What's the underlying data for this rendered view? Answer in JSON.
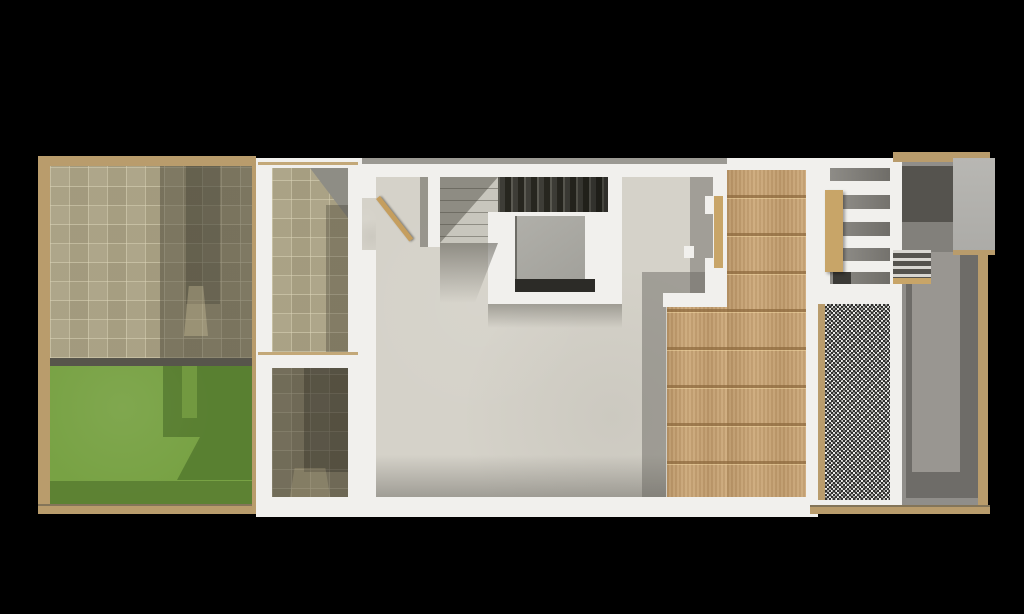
{
  "scene": {
    "title": "Top-down architectural floor plan render of a narrow row house with garden, light wells, staircase, wood deck, gravel bed and rear courtyard",
    "view": "top-down orthographic render",
    "background_color": "#000000",
    "width_px": 1024,
    "height_px": 614
  },
  "palette": {
    "background": "#000000",
    "wood_frame_tan": "#b99c6c",
    "tile_floor_beige": "#a9a184",
    "tile_grout": "#d8d1b7",
    "lawn_green": "#78a244",
    "lawn_shadow_green": "#5b8132",
    "wall_white": "#f1f0ed",
    "interior_floor_cream": "#d5d2c9",
    "stair_dark_tread": "#3a3934",
    "stair_light_tread": "#c6c4bb",
    "void_panel_gray": "#a9a8a2",
    "deck_wood": "#c6a274",
    "gravel_gray": "#a9a9a7",
    "courtyard_concrete": "#908e8a",
    "courtyard_shadow": "#6e6c68",
    "concrete_block": "#b4b3af"
  },
  "regions": [
    {
      "name": "garden-terrace-tiles",
      "label": "Front garden tiled terrace",
      "material": "beige ceramic tiles"
    },
    {
      "name": "garden-lawn",
      "label": "Front garden lawn",
      "material": "grass"
    },
    {
      "name": "perimeter-wood-fence",
      "label": "Timber fence border",
      "material": "wood"
    },
    {
      "name": "upper-light-well",
      "label": "Upper tiled light well / patio",
      "material": "beige ceramic tiles"
    },
    {
      "name": "lower-light-well",
      "label": "Lower tiled light well in shade",
      "material": "beige ceramic tiles"
    },
    {
      "name": "living-area-floor",
      "label": "Main interior room",
      "material": "light concrete screed"
    },
    {
      "name": "entry-door-open",
      "label": "Open door leaf into main room",
      "material": "wood"
    },
    {
      "name": "stair-light-flight",
      "label": "Lower stair flight with treads",
      "material": "concrete"
    },
    {
      "name": "stair-dark-flight",
      "label": "Upper dark stair flight",
      "material": "dark-stained treads"
    },
    {
      "name": "stair-void-panel",
      "label": "Stairwell void panel",
      "material": "gray panel"
    },
    {
      "name": "wood-deck",
      "label": "Rear wooden deck",
      "material": "wood planks"
    },
    {
      "name": "gravel-bed",
      "label": "Gravel strip",
      "material": "crushed stone"
    },
    {
      "name": "exterior-slat-stair",
      "label": "Exterior white slatted stair",
      "material": "painted steel"
    },
    {
      "name": "stair-handrail-plank",
      "label": "Wood plank on exterior stair",
      "material": "wood"
    },
    {
      "name": "rear-courtyard",
      "label": "Rear concrete courtyard",
      "material": "concrete"
    },
    {
      "name": "timber-steps",
      "label": "Small timber steps in courtyard",
      "material": "wood"
    },
    {
      "name": "concrete-block",
      "label": "Concrete block volume, top right",
      "material": "concrete"
    },
    {
      "name": "rear-wood-fence",
      "label": "Rear timber fence",
      "material": "wood"
    }
  ]
}
